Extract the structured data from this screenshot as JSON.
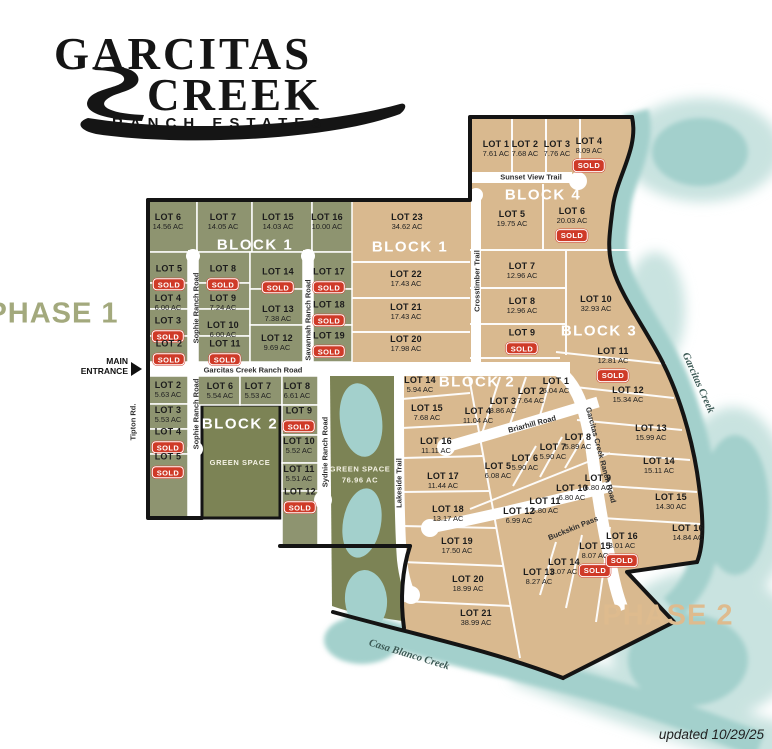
{
  "logo": {
    "line1": "GARCITAS",
    "line2": "CREEK",
    "line3": "RANCH ESTATES"
  },
  "phase1": {
    "label": "PHASE 1",
    "x": 53,
    "y": 314
  },
  "phase2": {
    "label": "PHASE 2",
    "x": 668,
    "y": 616
  },
  "entrance": {
    "line1": "MAIN",
    "line2": "ENTRANCE"
  },
  "updated": "updated 10/29/25",
  "colors": {
    "olive_lot": "#8e9470",
    "green_space": "#7c8355",
    "tan_lot": "#d9b98f",
    "water": "#a3d0cc",
    "water_light": "#c9e3e0",
    "sold_red": "#cf3a28",
    "boundary": "#141414",
    "road": "#ffffff",
    "phase1_text": "#a3a97d",
    "phase2_text": "#debb8e"
  },
  "block_labels": [
    {
      "text": "BLOCK 1",
      "x": 255,
      "y": 245
    },
    {
      "text": "BLOCK 1",
      "x": 410,
      "y": 247
    },
    {
      "text": "BLOCK 2",
      "x": 240,
      "y": 424
    },
    {
      "text": "BLOCK 2",
      "x": 477,
      "y": 382
    },
    {
      "text": "BLOCK 3",
      "x": 599,
      "y": 331
    },
    {
      "text": "BLOCK 4",
      "x": 543,
      "y": 195
    }
  ],
  "green_space_labels": [
    {
      "line1": "GREEN SPACE",
      "line2": "",
      "x": 240,
      "y": 463
    },
    {
      "line1": "GREEN SPACE",
      "line2": "76.96 AC",
      "x": 360,
      "y": 475
    }
  ],
  "road_labels": [
    {
      "text": "Sophie Ranch Road",
      "x": 196,
      "y": 308,
      "rot": -90
    },
    {
      "text": "Savannah Ranch Road",
      "x": 308,
      "y": 320,
      "rot": -90
    },
    {
      "text": "Sophie Ranch Road",
      "x": 196,
      "y": 414,
      "rot": -90
    },
    {
      "text": "Sydnie Ranch Road",
      "x": 325,
      "y": 452,
      "rot": -90
    },
    {
      "text": "Tipton Rd.",
      "x": 133,
      "y": 422,
      "rot": -90
    },
    {
      "text": "Lakeside Trail",
      "x": 399,
      "y": 483,
      "rot": -90
    },
    {
      "text": "Crosstimber Trail",
      "x": 477,
      "y": 281,
      "rot": -90
    },
    {
      "text": "Sunset View Trail",
      "x": 531,
      "y": 177,
      "rot": 0
    },
    {
      "text": "Garcitas Creek Ranch Road",
      "x": 253,
      "y": 370,
      "rot": 0
    },
    {
      "text": "Briarhill Road",
      "x": 532,
      "y": 424,
      "rot": -15
    },
    {
      "text": "Buckskin Pass",
      "x": 573,
      "y": 528,
      "rot": -22
    },
    {
      "text": "Garcitas Creek Ranch Road",
      "x": 601,
      "y": 455,
      "rot": 75
    }
  ],
  "creek_labels": [
    {
      "text": "Garcitas Creek",
      "x": 698,
      "y": 383,
      "rot": 66
    },
    {
      "text": "Casa Blanco Creek",
      "x": 409,
      "y": 655,
      "rot": 17
    }
  ],
  "lots": [
    {
      "n": "LOT 6",
      "a": "14.56 AC",
      "s": false,
      "x": 168,
      "y": 222
    },
    {
      "n": "LOT 7",
      "a": "14.05 AC",
      "s": false,
      "x": 223,
      "y": 222
    },
    {
      "n": "LOT 15",
      "a": "14.03 AC",
      "s": false,
      "x": 278,
      "y": 222
    },
    {
      "n": "LOT 16",
      "a": "10.00 AC",
      "s": false,
      "x": 327,
      "y": 222
    },
    {
      "n": "LOT 5",
      "a": null,
      "s": true,
      "x": 169,
      "y": 278
    },
    {
      "n": "LOT 4",
      "a": "6.00 AC",
      "s": false,
      "x": 168,
      "y": 303
    },
    {
      "n": "LOT 3",
      "a": null,
      "s": true,
      "x": 168,
      "y": 330
    },
    {
      "n": "LOT 2",
      "a": null,
      "s": true,
      "x": 169,
      "y": 353
    },
    {
      "n": "LOT 8",
      "a": null,
      "s": true,
      "x": 223,
      "y": 278
    },
    {
      "n": "LOT 9",
      "a": "7.24 AC",
      "s": false,
      "x": 223,
      "y": 303
    },
    {
      "n": "LOT 10",
      "a": "6.00 AC",
      "s": false,
      "x": 223,
      "y": 330
    },
    {
      "n": "LOT 11",
      "a": null,
      "s": true,
      "x": 225,
      "y": 353
    },
    {
      "n": "LOT 14",
      "a": null,
      "s": true,
      "x": 278,
      "y": 281
    },
    {
      "n": "LOT 13",
      "a": "7.38 AC",
      "s": false,
      "x": 278,
      "y": 314
    },
    {
      "n": "LOT 12",
      "a": "9.69 AC",
      "s": false,
      "x": 277,
      "y": 343
    },
    {
      "n": "LOT 17",
      "a": null,
      "s": true,
      "x": 329,
      "y": 281
    },
    {
      "n": "LOT 18",
      "a": null,
      "s": true,
      "x": 329,
      "y": 314
    },
    {
      "n": "LOT 19",
      "a": null,
      "s": true,
      "x": 329,
      "y": 345
    },
    {
      "n": "LOT 2",
      "a": "5.63 AC",
      "s": false,
      "x": 168,
      "y": 390
    },
    {
      "n": "LOT 3",
      "a": "5.53 AC",
      "s": false,
      "x": 168,
      "y": 415
    },
    {
      "n": "LOT 4",
      "a": null,
      "s": true,
      "x": 168,
      "y": 441
    },
    {
      "n": "LOT 5",
      "a": null,
      "s": true,
      "x": 168,
      "y": 466
    },
    {
      "n": "LOT 6",
      "a": "5.54 AC",
      "s": false,
      "x": 220,
      "y": 391
    },
    {
      "n": "LOT 7",
      "a": "5.53 AC",
      "s": false,
      "x": 258,
      "y": 391
    },
    {
      "n": "LOT 8",
      "a": "6.61 AC",
      "s": false,
      "x": 297,
      "y": 391
    },
    {
      "n": "LOT 9",
      "a": null,
      "s": true,
      "x": 299,
      "y": 420
    },
    {
      "n": "LOT 10",
      "a": "5.52 AC",
      "s": false,
      "x": 299,
      "y": 446
    },
    {
      "n": "LOT 11",
      "a": "5.51 AC",
      "s": false,
      "x": 299,
      "y": 474
    },
    {
      "n": "LOT 12",
      "a": null,
      "s": true,
      "x": 300,
      "y": 501
    },
    {
      "n": "LOT 23",
      "a": "34.62 AC",
      "s": false,
      "x": 407,
      "y": 222
    },
    {
      "n": "LOT 22",
      "a": "17.43 AC",
      "s": false,
      "x": 406,
      "y": 279
    },
    {
      "n": "LOT 21",
      "a": "17.43 AC",
      "s": false,
      "x": 406,
      "y": 312
    },
    {
      "n": "LOT 20",
      "a": "17.98 AC",
      "s": false,
      "x": 406,
      "y": 344
    },
    {
      "n": "LOT 1",
      "a": "7.61 AC",
      "s": false,
      "x": 496,
      "y": 149
    },
    {
      "n": "LOT 2",
      "a": "7.68 AC",
      "s": false,
      "x": 525,
      "y": 149
    },
    {
      "n": "LOT 3",
      "a": "7.76 AC",
      "s": false,
      "x": 557,
      "y": 149
    },
    {
      "n": "LOT 4",
      "a": "8.09 AC",
      "s": true,
      "x": 589,
      "y": 155
    },
    {
      "n": "LOT 5",
      "a": "19.75 AC",
      "s": false,
      "x": 512,
      "y": 219
    },
    {
      "n": "LOT 6",
      "a": "20.03 AC",
      "s": true,
      "x": 572,
      "y": 225
    },
    {
      "n": "LOT 7",
      "a": "12.96 AC",
      "s": false,
      "x": 522,
      "y": 271
    },
    {
      "n": "LOT 8",
      "a": "12.96 AC",
      "s": false,
      "x": 522,
      "y": 306
    },
    {
      "n": "LOT 9",
      "a": null,
      "s": true,
      "x": 522,
      "y": 342
    },
    {
      "n": "LOT 10",
      "a": "32.93 AC",
      "s": false,
      "x": 596,
      "y": 304
    },
    {
      "n": "LOT 11",
      "a": "12.81 AC",
      "s": true,
      "x": 613,
      "y": 365
    },
    {
      "n": "LOT 12",
      "a": "15.34 AC",
      "s": false,
      "x": 628,
      "y": 395
    },
    {
      "n": "LOT 13",
      "a": "15.99 AC",
      "s": false,
      "x": 651,
      "y": 433
    },
    {
      "n": "LOT 14",
      "a": "15.11 AC",
      "s": false,
      "x": 659,
      "y": 466
    },
    {
      "n": "LOT 15",
      "a": "14.30 AC",
      "s": false,
      "x": 671,
      "y": 502
    },
    {
      "n": "LOT 16",
      "a": "14.84 AC",
      "s": false,
      "x": 688,
      "y": 533
    },
    {
      "n": "LOT 14",
      "a": "5.94 AC",
      "s": false,
      "x": 420,
      "y": 385
    },
    {
      "n": "LOT 15",
      "a": "7.68 AC",
      "s": false,
      "x": 427,
      "y": 413
    },
    {
      "n": "LOT 16",
      "a": "11.11 AC",
      "s": false,
      "x": 436,
      "y": 446
    },
    {
      "n": "LOT 17",
      "a": "11.44 AC",
      "s": false,
      "x": 443,
      "y": 481
    },
    {
      "n": "LOT 18",
      "a": "13.17 AC",
      "s": false,
      "x": 448,
      "y": 514
    },
    {
      "n": "LOT 19",
      "a": "17.50 AC",
      "s": false,
      "x": 457,
      "y": 546
    },
    {
      "n": "LOT 20",
      "a": "18.99 AC",
      "s": false,
      "x": 468,
      "y": 584
    },
    {
      "n": "LOT 21",
      "a": "38.99 AC",
      "s": false,
      "x": 476,
      "y": 618
    },
    {
      "n": "LOT 4",
      "a": "11.04 AC",
      "s": false,
      "x": 478,
      "y": 416
    },
    {
      "n": "LOT 3",
      "a": "8.86 AC",
      "s": false,
      "x": 503,
      "y": 406
    },
    {
      "n": "LOT 2",
      "a": "7.64 AC",
      "s": false,
      "x": 531,
      "y": 396
    },
    {
      "n": "LOT 1",
      "a": "6.04 AC",
      "s": false,
      "x": 556,
      "y": 386
    },
    {
      "n": "LOT 5",
      "a": "6.08 AC",
      "s": false,
      "x": 498,
      "y": 471
    },
    {
      "n": "LOT 6",
      "a": "5.90 AC",
      "s": false,
      "x": 525,
      "y": 463
    },
    {
      "n": "LOT 7",
      "a": "5.90 AC",
      "s": false,
      "x": 553,
      "y": 452
    },
    {
      "n": "LOT 8",
      "a": "5.89 AC",
      "s": false,
      "x": 578,
      "y": 442
    },
    {
      "n": "LOT 9",
      "a": "6.80 AC",
      "s": false,
      "x": 598,
      "y": 483
    },
    {
      "n": "LOT 10",
      "a": "6.80 AC",
      "s": false,
      "x": 572,
      "y": 493
    },
    {
      "n": "LOT 11",
      "a": "6.80 AC",
      "s": false,
      "x": 545,
      "y": 506
    },
    {
      "n": "LOT 12",
      "a": "6.99 AC",
      "s": false,
      "x": 519,
      "y": 516
    },
    {
      "n": "LOT 13",
      "a": "8.27 AC",
      "s": false,
      "x": 539,
      "y": 577
    },
    {
      "n": "LOT 14",
      "a": "8.07 AC",
      "s": false,
      "x": 564,
      "y": 567
    },
    {
      "n": "LOT 15",
      "a": "8.07 AC",
      "s": true,
      "x": 595,
      "y": 560
    },
    {
      "n": "LOT 16",
      "a": "8.01 AC",
      "s": true,
      "x": 622,
      "y": 550
    }
  ]
}
